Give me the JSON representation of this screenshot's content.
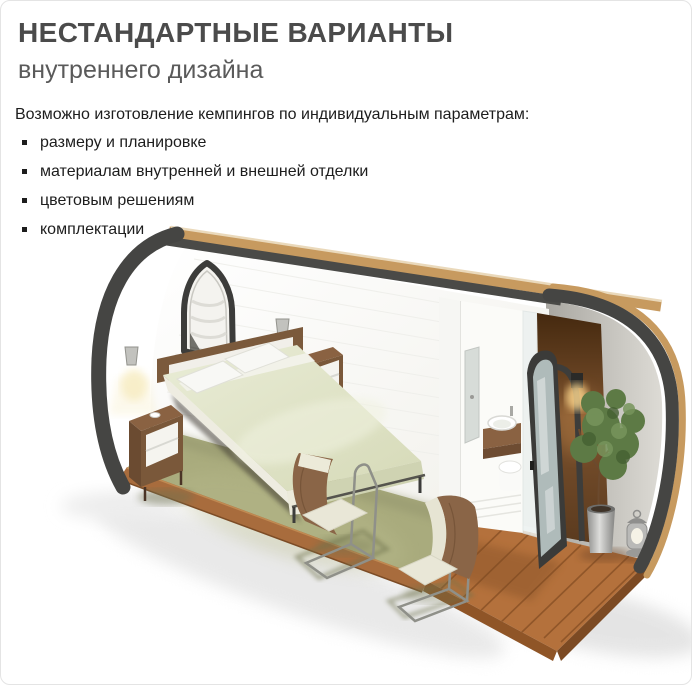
{
  "page": {
    "background": "#ffffff",
    "frame_border": "#e4e4e4"
  },
  "header": {
    "title": "НЕСТАНДАРТНЫЕ ВАРИАНТЫ",
    "subtitle": "внутреннего дизайна",
    "title_color": "#4b4b4b",
    "subtitle_color": "#5a5a5a"
  },
  "body": {
    "intro": "Возможно изготовление кемпингов по индивидуальным параметрам:",
    "bullets": [
      "размеру и планировке",
      "материалам внутренней и внешней отделки",
      "цветовым решениям",
      "комплектации"
    ],
    "text_color": "#1d1d1d"
  },
  "illustration": {
    "alt": "3D-разрез кемпинг-модуля: спальня с кроватью, два кресла, санузел, открытая дверь, растение и деревянная терраса",
    "colors": {
      "shell": "#454543",
      "roof_edge_wood": "#c79a5f",
      "interior_wall": "#fbfaf7",
      "carpet": "#a9ab7d",
      "deck_wood": "#b4713c",
      "bedding": "#dfe2c6",
      "furniture_wood": "#8a6242",
      "foliage": "#5d7a45",
      "door_glass": "#b5c2c1"
    }
  }
}
